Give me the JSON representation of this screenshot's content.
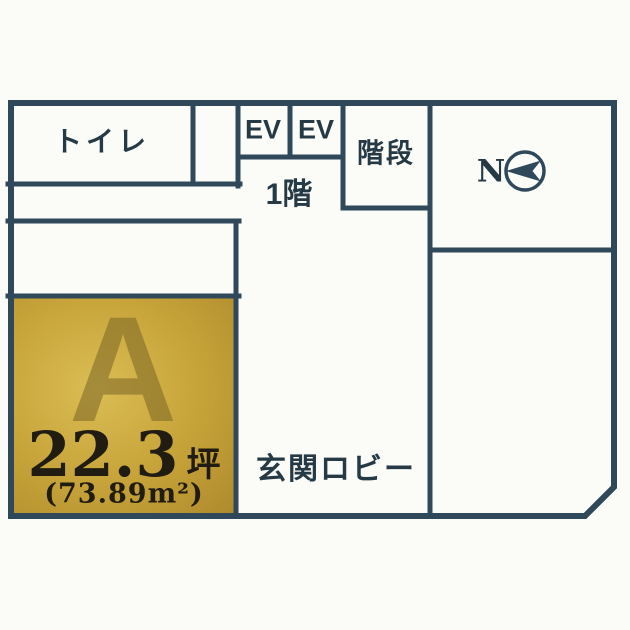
{
  "plan": {
    "floor_label": "1階",
    "rooms": {
      "toilet_label": "トイレ",
      "ev1_label": "EV",
      "ev2_label": "EV",
      "stairs_label": "階段",
      "lobby_label": "玄関ロビー"
    },
    "compass": {
      "north_label": "N"
    },
    "unit_a": {
      "name": "A",
      "area_tsubo_value": "22.3",
      "area_tsubo_unit": "坪",
      "area_sqm_text": "(73.89m²)"
    },
    "colors": {
      "wall": "#30495a",
      "text": "#263a46",
      "unit_fill_light": "#dabd55",
      "unit_fill_mid": "#c7a43a",
      "unit_fill_dark": "#b08a2c",
      "unit_ink": "#211c11",
      "paper": "#fbfbf8"
    }
  }
}
